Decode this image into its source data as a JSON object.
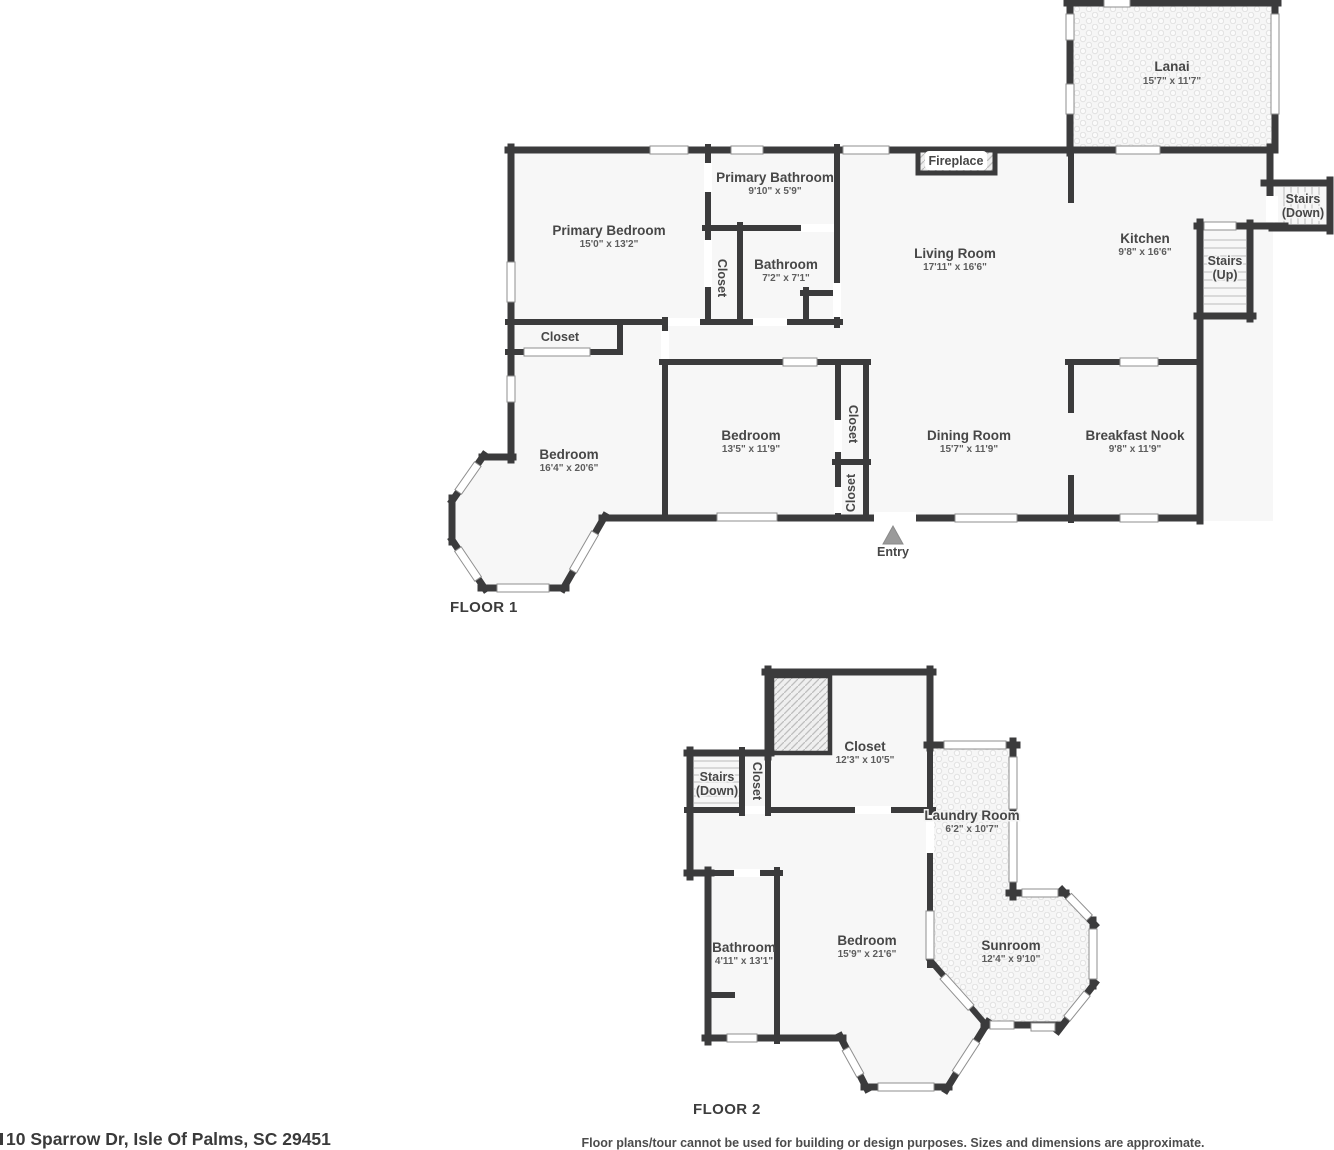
{
  "meta": {
    "address": "10 Sparrow Dr, Isle Of Palms, SC 29451",
    "disclaimer": "Floor plans/tour cannot be used for building or design purposes. Sizes and dimensions are approximate."
  },
  "colors": {
    "wall": "#3b3b3c",
    "room_fill": "#f7f7f7",
    "label": "#474747",
    "entry_arrow": "#9a9a9a"
  },
  "shared": {
    "closet": "Closet",
    "stairs": "Stairs",
    "down": "(Down)",
    "up": "(Up)",
    "entry": "Entry",
    "fireplace": "Fireplace"
  },
  "floor1": {
    "title": "FLOOR 1",
    "lanai": {
      "name": "Lanai",
      "dims": "15'7\" x 11'7\""
    },
    "primary_bedroom": {
      "name": "Primary Bedroom",
      "dims": "15'0\" x 13'2\""
    },
    "primary_bathroom": {
      "name": "Primary Bathroom",
      "dims": "9'10\" x 5'9\""
    },
    "bathroom": {
      "name": "Bathroom",
      "dims": "7'2\" x 7'1\""
    },
    "living_room": {
      "name": "Living Room",
      "dims": "17'11\" x 16'6\""
    },
    "kitchen": {
      "name": "Kitchen",
      "dims": "9'8\" x 16'6\""
    },
    "dining_room": {
      "name": "Dining Room",
      "dims": "15'7\" x 11'9\""
    },
    "breakfast_nook": {
      "name": "Breakfast Nook",
      "dims": "9'8\" x 11'9\""
    },
    "bedroom_left": {
      "name": "Bedroom",
      "dims": "16'4\" x 20'6\""
    },
    "bedroom_middle": {
      "name": "Bedroom",
      "dims": "13'5\" x 11'9\""
    }
  },
  "floor2": {
    "title": "FLOOR 2",
    "closet": {
      "name": "Closet",
      "dims": "12'3\" x 10'5\""
    },
    "laundry_room": {
      "name": "Laundry Room",
      "dims": "6'2\" x 10'7\""
    },
    "bathroom": {
      "name": "Bathroom",
      "dims": "4'11\" x 13'1\""
    },
    "bedroom": {
      "name": "Bedroom",
      "dims": "15'9\" x 21'6\""
    },
    "sunroom": {
      "name": "Sunroom",
      "dims": "12'4\" x 9'10\""
    }
  }
}
